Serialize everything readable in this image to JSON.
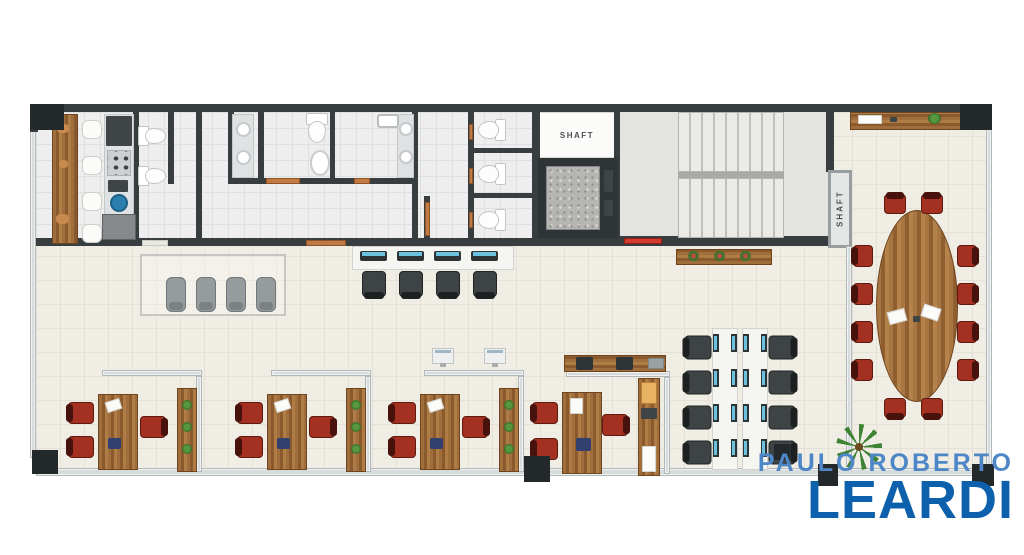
{
  "branding": {
    "line1": "PAULO ROBERTO",
    "line2": "LEARDI",
    "line1_color": "#4d87c7",
    "line2_color": "#0d61ac"
  },
  "labels": {
    "shaft_elevator": "SHAFT",
    "shaft_side": "SHAFT"
  },
  "palette": {
    "wall": "#383d40",
    "floor": "#f0ede4",
    "bath_floor": "#edeeed",
    "wood": "#a06e3c",
    "chair_red": "#a33020",
    "chair_dark": "#3e4346",
    "chair_gray": "#969b9d",
    "glass_partition": "#d7dbdc",
    "door": "#c07a45",
    "emergency_red": "#d23b2e",
    "screen_blue": "#6ac2de",
    "plant_green": "#3f8434"
  },
  "floorplan": {
    "names": {
      "floor-main": "office-floor",
      "floor-bath": "restroom-floor",
      "floor-stairs": "stairwell-floor",
      "room-white": "shaft-room",
      "wall": "wall",
      "column": "structural-column",
      "glass": "glass-partition",
      "door": "door",
      "door-light": "door",
      "door-red": "emergency-door",
      "shaft-frame": "shaft-duct",
      "stairs": "stair-flight",
      "stair-divider": "stair-landing-edge",
      "elevator-frame": "elevator",
      "elevator-floor": "elevator-cab",
      "wood": "wood-cabinet",
      "wood-h": "wood-sideboard",
      "desk": "office-desk",
      "table-oval": "conference-table",
      "chair-red": "red-chair",
      "chair-dark": "task-chair",
      "chair-gray": "lounge-chair",
      "stool": "bar-stool",
      "toilet": "toilet",
      "basin": "washbasin",
      "oval": "washbasin",
      "sink-rect": "sink",
      "vanity": "vanity-counter",
      "sink-blue": "kitchen-sink",
      "fridge": "refrigerator",
      "appliance": "appliance",
      "stove": "cooktop",
      "printer": "printer",
      "box-orange": "storage-box",
      "item-gray": "desk-item",
      "item-blue": "desk-item",
      "deco": "decor-item",
      "paper": "papers",
      "bench": "workstation-bench",
      "monitor": "computer-monitor",
      "monitor-v": "computer-monitor",
      "monitor-white": "computer-monitor",
      "rug": "waiting-area-rug",
      "plant": "potted-plant",
      "flower": "flower-vase",
      "palm": "palm-plant"
    },
    "elements": [
      [
        "floor-main",
        36,
        112,
        952,
        358
      ],
      [
        "floor-bath",
        36,
        112,
        500,
        130
      ],
      [
        "floor-stairs",
        618,
        112,
        210,
        126
      ],
      [
        "room-white",
        536,
        112,
        80,
        46
      ],
      [
        "glass",
        30,
        128,
        6,
        330
      ],
      [
        "glass",
        36,
        468,
        950,
        8
      ],
      [
        "glass",
        986,
        128,
        6,
        344
      ],
      [
        "wall",
        30,
        104,
        958,
        8
      ],
      [
        "wall",
        30,
        112,
        8,
        20
      ],
      [
        "wall",
        532,
        104,
        8,
        142
      ],
      [
        "wall",
        614,
        112,
        6,
        126
      ],
      [
        "wall",
        826,
        112,
        8,
        60
      ],
      [
        "wall",
        532,
        236,
        304,
        10
      ],
      [
        "wall",
        36,
        238,
        500,
        8
      ],
      [
        "wall",
        133,
        112,
        6,
        132
      ],
      [
        "wall",
        168,
        112,
        6,
        72
      ],
      [
        "wall",
        196,
        112,
        6,
        132
      ],
      [
        "wall",
        228,
        112,
        6,
        72
      ],
      [
        "wall",
        258,
        112,
        6,
        72
      ],
      [
        "wall",
        330,
        112,
        5,
        72
      ],
      [
        "wall",
        412,
        112,
        6,
        132
      ],
      [
        "wall",
        468,
        112,
        6,
        132
      ],
      [
        "wall",
        228,
        178,
        190,
        6
      ],
      [
        "wall",
        468,
        148,
        66,
        5
      ],
      [
        "wall",
        468,
        193,
        66,
        5
      ],
      [
        "wall",
        424,
        196,
        6,
        46
      ],
      [
        "door-light",
        142,
        240,
        26,
        6
      ],
      [
        "door",
        266,
        178,
        34,
        6
      ],
      [
        "door",
        354,
        178,
        16,
        6
      ],
      [
        "door",
        306,
        240,
        40,
        6
      ],
      [
        "door",
        425,
        202,
        5,
        34
      ],
      [
        "door",
        469,
        124,
        4,
        16
      ],
      [
        "door",
        469,
        168,
        4,
        16
      ],
      [
        "door",
        469,
        212,
        4,
        16
      ],
      [
        "door-red",
        624,
        238,
        38,
        6
      ],
      [
        "toilet",
        140,
        122,
        24,
        28,
        -90
      ],
      [
        "toilet",
        140,
        162,
        24,
        28,
        -90
      ],
      [
        "toilet",
        304,
        113,
        26,
        30
      ],
      [
        "oval",
        310,
        150,
        20,
        26
      ],
      [
        "toilet",
        479,
        116,
        26,
        28,
        90
      ],
      [
        "toilet",
        479,
        160,
        26,
        28,
        90
      ],
      [
        "toilet",
        479,
        206,
        26,
        28,
        90
      ],
      [
        "vanity",
        232,
        114,
        22,
        64
      ],
      [
        "basin",
        236,
        122,
        15,
        15
      ],
      [
        "basin",
        236,
        150,
        15,
        15
      ],
      [
        "vanity",
        397,
        114,
        17,
        64
      ],
      [
        "basin",
        399,
        122,
        14,
        14
      ],
      [
        "basin",
        399,
        150,
        14,
        14
      ],
      [
        "sink-rect",
        377,
        114,
        22,
        14
      ],
      [
        "wood",
        52,
        114,
        26,
        130
      ],
      [
        "deco",
        57,
        124,
        12,
        9
      ],
      [
        "deco",
        59,
        160,
        9,
        8
      ],
      [
        "deco",
        56,
        214,
        13,
        10
      ],
      [
        "stool",
        82,
        120,
        20,
        19
      ],
      [
        "stool",
        82,
        156,
        20,
        19
      ],
      [
        "stool",
        82,
        192,
        20,
        19
      ],
      [
        "stool",
        82,
        224,
        20,
        19
      ],
      [
        "vanity",
        104,
        114,
        30,
        126
      ],
      [
        "appliance",
        106,
        116,
        26,
        30
      ],
      [
        "stove",
        107,
        150,
        24,
        26
      ],
      [
        "appliance",
        108,
        180,
        20,
        12
      ],
      [
        "sink-blue",
        110,
        194,
        18,
        18
      ],
      [
        "fridge",
        102,
        214,
        34,
        26
      ],
      [
        "elevator-frame",
        538,
        158,
        80,
        80
      ],
      [
        "elevator-floor",
        546,
        166,
        54,
        64
      ],
      [
        "appliance",
        604,
        170,
        9,
        22
      ],
      [
        "appliance",
        604,
        200,
        9,
        16
      ],
      [
        "stairs",
        678,
        112,
        106,
        60
      ],
      [
        "stair-divider",
        678,
        172,
        106,
        6
      ],
      [
        "stairs",
        678,
        178,
        106,
        60
      ],
      [
        "shaft-frame",
        828,
        170,
        24,
        78
      ],
      [
        "wood-h",
        850,
        112,
        114,
        18
      ],
      [
        "paper",
        858,
        115,
        24,
        9
      ],
      [
        "appliance",
        890,
        117,
        7,
        5
      ],
      [
        "plant",
        928,
        113,
        13,
        11
      ],
      [
        "wood-h",
        676,
        249,
        96,
        16
      ],
      [
        "flower",
        688,
        251,
        11,
        10
      ],
      [
        "flower",
        714,
        251,
        11,
        10
      ],
      [
        "flower",
        740,
        251,
        11,
        10
      ],
      [
        "rug",
        140,
        254,
        146,
        62
      ],
      [
        "chair-gray",
        166,
        277,
        20,
        35
      ],
      [
        "chair-gray",
        196,
        277,
        20,
        35
      ],
      [
        "chair-gray",
        226,
        277,
        20,
        35
      ],
      [
        "chair-gray",
        256,
        277,
        20,
        35
      ],
      [
        "bench",
        352,
        246,
        162,
        24
      ],
      [
        "monitor",
        360,
        251,
        27,
        10
      ],
      [
        "monitor",
        397,
        251,
        27,
        10
      ],
      [
        "monitor",
        434,
        251,
        27,
        10
      ],
      [
        "monitor",
        471,
        251,
        27,
        10
      ],
      [
        "chair-dark",
        362,
        271,
        24,
        26,
        180
      ],
      [
        "chair-dark",
        399,
        271,
        24,
        26,
        180
      ],
      [
        "chair-dark",
        436,
        271,
        24,
        26,
        180
      ],
      [
        "chair-dark",
        473,
        271,
        24,
        26,
        180
      ],
      [
        "monitor-white",
        432,
        348,
        22,
        16
      ],
      [
        "monitor-white",
        484,
        348,
        22,
        16
      ],
      [
        "glass",
        102,
        370,
        100,
        6
      ],
      [
        "glass",
        196,
        376,
        6,
        96
      ],
      [
        "wood",
        177,
        388,
        20,
        84
      ],
      [
        "plant",
        182,
        400,
        10,
        10
      ],
      [
        "plant",
        182,
        422,
        10,
        10
      ],
      [
        "plant",
        182,
        444,
        10,
        10
      ],
      [
        "desk",
        98,
        394,
        40,
        76
      ],
      [
        "paper",
        106,
        400,
        15,
        11,
        -18
      ],
      [
        "item-blue",
        108,
        438,
        13,
        11
      ],
      [
        "chair-red",
        70,
        400,
        22,
        26,
        -90
      ],
      [
        "chair-red",
        70,
        434,
        22,
        26,
        -90
      ],
      [
        "chair-red",
        142,
        414,
        22,
        26,
        90
      ],
      [
        "glass",
        271,
        370,
        100,
        6
      ],
      [
        "glass",
        365,
        376,
        6,
        96
      ],
      [
        "wood",
        346,
        388,
        20,
        84
      ],
      [
        "plant",
        351,
        400,
        10,
        10
      ],
      [
        "plant",
        351,
        422,
        10,
        10
      ],
      [
        "plant",
        351,
        444,
        10,
        10
      ],
      [
        "desk",
        267,
        394,
        40,
        76
      ],
      [
        "paper",
        275,
        400,
        15,
        11,
        -18
      ],
      [
        "item-blue",
        277,
        438,
        13,
        11
      ],
      [
        "chair-red",
        239,
        400,
        22,
        26,
        -90
      ],
      [
        "chair-red",
        239,
        434,
        22,
        26,
        -90
      ],
      [
        "chair-red",
        311,
        414,
        22,
        26,
        90
      ],
      [
        "glass",
        424,
        370,
        100,
        6
      ],
      [
        "glass",
        518,
        376,
        6,
        96
      ],
      [
        "wood",
        499,
        388,
        20,
        84
      ],
      [
        "plant",
        504,
        400,
        10,
        10
      ],
      [
        "plant",
        504,
        422,
        10,
        10
      ],
      [
        "plant",
        504,
        444,
        10,
        10
      ],
      [
        "desk",
        420,
        394,
        40,
        76
      ],
      [
        "paper",
        428,
        400,
        15,
        11,
        -18
      ],
      [
        "item-blue",
        430,
        438,
        13,
        11
      ],
      [
        "chair-red",
        392,
        400,
        22,
        26,
        -90
      ],
      [
        "chair-red",
        392,
        434,
        22,
        26,
        -90
      ],
      [
        "chair-red",
        464,
        414,
        22,
        26,
        90
      ],
      [
        "glass",
        566,
        371,
        104,
        6
      ],
      [
        "glass",
        664,
        377,
        6,
        97
      ],
      [
        "wood-h",
        564,
        355,
        102,
        17
      ],
      [
        "printer",
        576,
        357,
        17,
        13
      ],
      [
        "printer",
        616,
        357,
        17,
        13
      ],
      [
        "item-gray",
        648,
        358,
        16,
        11
      ],
      [
        "desk",
        562,
        392,
        40,
        82
      ],
      [
        "paper",
        570,
        398,
        13,
        16
      ],
      [
        "item-blue",
        576,
        438,
        15,
        13
      ],
      [
        "chair-red",
        534,
        400,
        22,
        26,
        -90
      ],
      [
        "chair-red",
        534,
        436,
        22,
        26,
        -90
      ],
      [
        "chair-red",
        604,
        412,
        22,
        26,
        90
      ],
      [
        "wood",
        638,
        378,
        22,
        98
      ],
      [
        "box-orange",
        641,
        382,
        16,
        22
      ],
      [
        "appliance",
        641,
        408,
        16,
        11
      ],
      [
        "paper",
        642,
        446,
        14,
        26
      ],
      [
        "bench",
        712,
        328,
        26,
        142
      ],
      [
        "bench",
        742,
        328,
        26,
        142
      ],
      [
        "monitor-v",
        713,
        334,
        6,
        18
      ],
      [
        "monitor-v",
        731,
        334,
        6,
        18
      ],
      [
        "monitor-v",
        743,
        334,
        6,
        18
      ],
      [
        "monitor-v",
        761,
        334,
        6,
        18
      ],
      [
        "monitor-v",
        713,
        369,
        6,
        18
      ],
      [
        "monitor-v",
        731,
        369,
        6,
        18
      ],
      [
        "monitor-v",
        743,
        369,
        6,
        18
      ],
      [
        "monitor-v",
        761,
        369,
        6,
        18
      ],
      [
        "monitor-v",
        713,
        404,
        6,
        18
      ],
      [
        "monitor-v",
        731,
        404,
        6,
        18
      ],
      [
        "monitor-v",
        743,
        404,
        6,
        18
      ],
      [
        "monitor-v",
        761,
        404,
        6,
        18
      ],
      [
        "monitor-v",
        713,
        439,
        6,
        18
      ],
      [
        "monitor-v",
        731,
        439,
        6,
        18
      ],
      [
        "monitor-v",
        743,
        439,
        6,
        18
      ],
      [
        "monitor-v",
        761,
        439,
        6,
        18
      ],
      [
        "chair-dark",
        686,
        334,
        24,
        27,
        -90
      ],
      [
        "chair-dark",
        686,
        369,
        24,
        27,
        -90
      ],
      [
        "chair-dark",
        686,
        404,
        24,
        27,
        -90
      ],
      [
        "chair-dark",
        686,
        439,
        24,
        27,
        -90
      ],
      [
        "chair-dark",
        770,
        334,
        24,
        27,
        90
      ],
      [
        "chair-dark",
        770,
        369,
        24,
        27,
        90
      ],
      [
        "chair-dark",
        770,
        404,
        24,
        27,
        90
      ],
      [
        "chair-dark",
        770,
        439,
        24,
        27,
        90
      ],
      [
        "glass",
        846,
        246,
        6,
        224
      ],
      [
        "table-oval",
        876,
        210,
        82,
        192
      ],
      [
        "paper",
        888,
        310,
        18,
        13,
        -15
      ],
      [
        "paper",
        922,
        306,
        18,
        13,
        18
      ],
      [
        "appliance",
        913,
        316,
        7,
        6
      ],
      [
        "chair-red",
        884,
        194,
        22,
        20
      ],
      [
        "chair-red",
        921,
        194,
        22,
        20
      ],
      [
        "chair-red",
        884,
        398,
        22,
        20,
        180
      ],
      [
        "chair-red",
        921,
        398,
        22,
        20,
        180
      ],
      [
        "chair-red",
        852,
        246,
        22,
        20,
        -90
      ],
      [
        "chair-red",
        852,
        284,
        22,
        20,
        -90
      ],
      [
        "chair-red",
        852,
        322,
        22,
        20,
        -90
      ],
      [
        "chair-red",
        852,
        360,
        22,
        20,
        -90
      ],
      [
        "chair-red",
        956,
        246,
        22,
        20,
        90
      ],
      [
        "chair-red",
        956,
        284,
        22,
        20,
        90
      ],
      [
        "chair-red",
        956,
        322,
        22,
        20,
        90
      ],
      [
        "chair-red",
        956,
        360,
        22,
        20,
        90
      ],
      [
        "palm",
        836,
        424,
        46,
        46
      ],
      [
        "column",
        30,
        104,
        34,
        26
      ],
      [
        "column",
        960,
        104,
        32,
        26
      ],
      [
        "column",
        32,
        450,
        26,
        24
      ],
      [
        "column",
        524,
        456,
        26,
        26
      ],
      [
        "column",
        774,
        444,
        16,
        16
      ],
      [
        "column",
        818,
        464,
        20,
        22
      ],
      [
        "column",
        972,
        464,
        22,
        22
      ]
    ]
  }
}
